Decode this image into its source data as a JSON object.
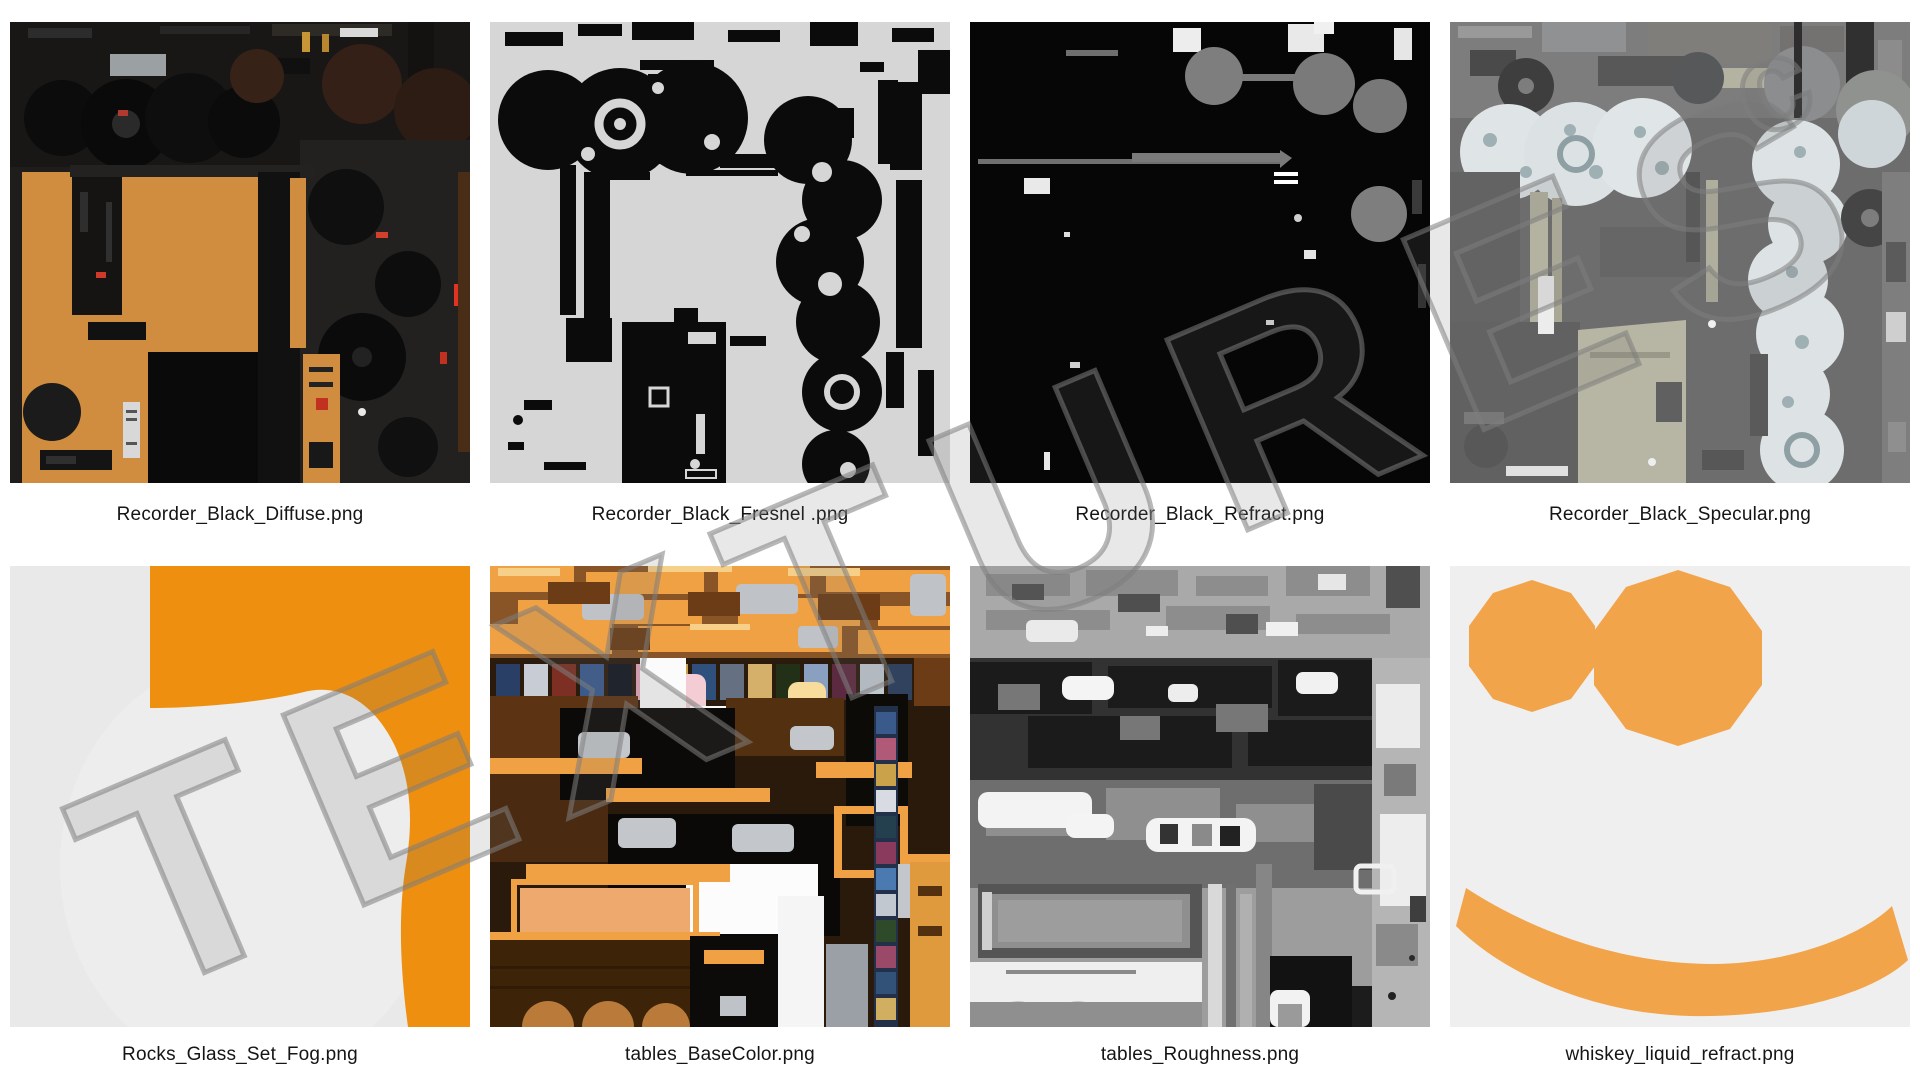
{
  "page": {
    "background": "#ffffff"
  },
  "watermark": {
    "text": "TEXTURES",
    "suffix": "c"
  },
  "palette": {
    "wood": "#d08c3f",
    "orange-bright": "#ee8f0f",
    "orange-soft": "#f2a44b",
    "orange-table": "#f0a144",
    "label": "#151515"
  },
  "grid": {
    "columns": 4,
    "rows": 2
  },
  "tiles": [
    {
      "label": "Recorder_Black_Diffuse.png"
    },
    {
      "label": "Recorder_Black_Fresnel .png"
    },
    {
      "label": "Recorder_Black_Refract.png"
    },
    {
      "label": "Recorder_Black_Specular.png"
    },
    {
      "label": "Rocks_Glass_Set_Fog.png"
    },
    {
      "label": "tables_BaseColor.png"
    },
    {
      "label": "tables_Roughness.png"
    },
    {
      "label": "whiskey_liquid_refract.png"
    }
  ]
}
